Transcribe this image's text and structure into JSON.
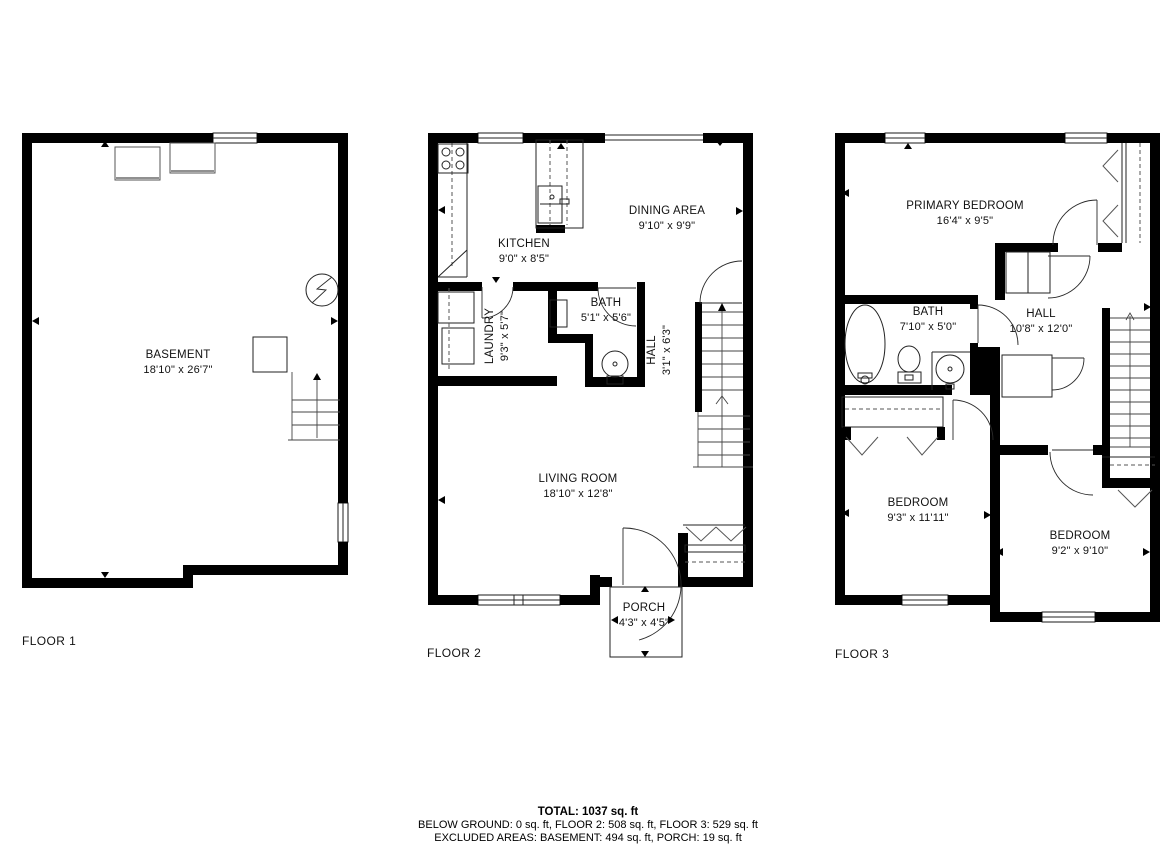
{
  "canvas": {
    "width": 1176,
    "height": 860,
    "background": "#ffffff",
    "line_color": "#000000"
  },
  "floors": [
    {
      "label": "FLOOR 1",
      "rooms": [
        {
          "name": "BASEMENT",
          "dims": "18'10\" x 26'7\""
        }
      ],
      "symbols": [
        "window",
        "storage-box",
        "storage-box",
        "electric-meter",
        "utility-box",
        "stairs-up-arrow"
      ]
    },
    {
      "label": "FLOOR 2",
      "rooms": [
        {
          "name": "KITCHEN",
          "dims": "9'0\" x 8'5\""
        },
        {
          "name": "DINING AREA",
          "dims": "9'10\" x 9'9\""
        },
        {
          "name": "LAUNDRY",
          "dims": "9'3\" x 5'7\""
        },
        {
          "name": "BATH",
          "dims": "5'1\" x 5'6\""
        },
        {
          "name": "HALL",
          "dims": "3'1\" x 6'3\""
        },
        {
          "name": "LIVING ROOM",
          "dims": "18'10\" x 12'8\""
        },
        {
          "name": "PORCH",
          "dims": "4'3\" x 4'5\""
        }
      ],
      "symbols": [
        "stove",
        "island-sink",
        "washer",
        "dryer",
        "toilet",
        "door-arc",
        "stairs-up-arrow",
        "closet-hangers",
        "window",
        "porch-outline"
      ]
    },
    {
      "label": "FLOOR 3",
      "rooms": [
        {
          "name": "PRIMARY BEDROOM",
          "dims": "16'4\" x 9'5\""
        },
        {
          "name": "BATH",
          "dims": "7'10\" x 5'0\""
        },
        {
          "name": "HALL",
          "dims": "10'8\" x 12'0\""
        },
        {
          "name": "BEDROOM",
          "dims": "9'3\" x 11'11\""
        },
        {
          "name": "BEDROOM",
          "dims": "9'2\" x 9'10\""
        }
      ],
      "symbols": [
        "bathtub",
        "toilet",
        "sink",
        "closet-hangers",
        "linen-closet",
        "stairs",
        "door-arc",
        "window"
      ]
    }
  ],
  "summary": {
    "total": "TOTAL: 1037 sq. ft",
    "floors_line": "BELOW GROUND: 0 sq. ft, FLOOR 2: 508 sq. ft, FLOOR 3: 529 sq. ft",
    "excluded_line": "EXCLUDED AREAS: BASEMENT: 494 sq. ft, PORCH: 19 sq. ft"
  }
}
